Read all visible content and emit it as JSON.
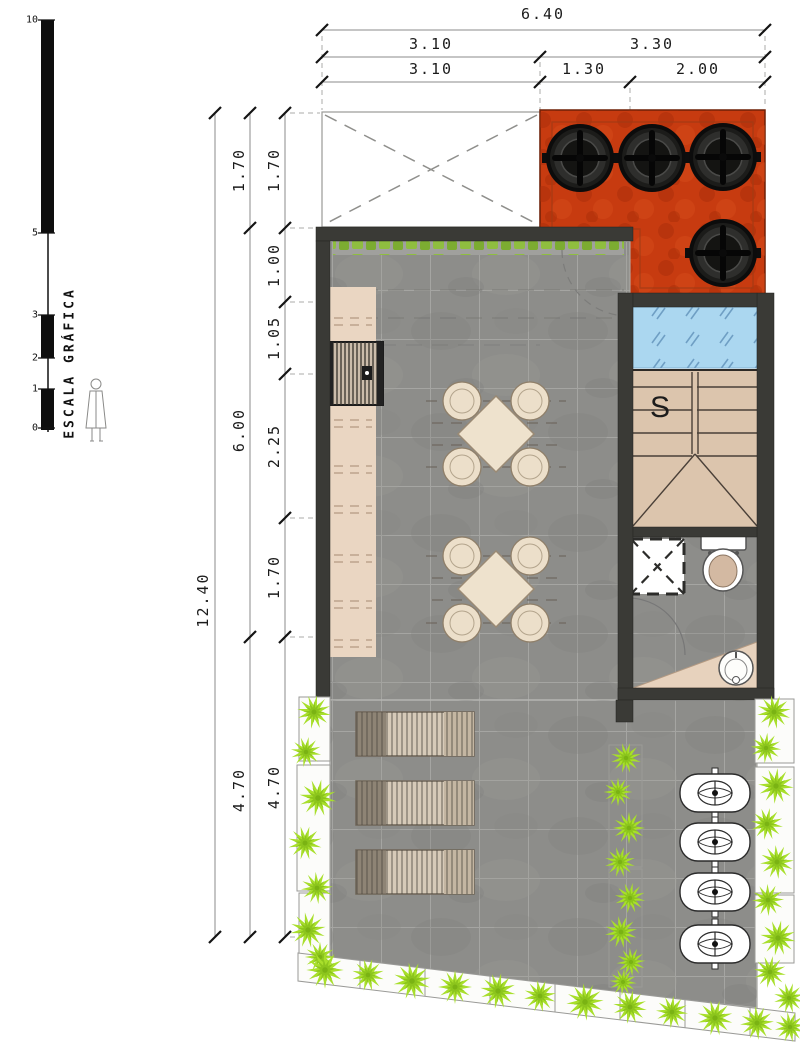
{
  "scale_bar": {
    "label": "ESCALA GRÁFICA",
    "ticks": [
      "10",
      "5",
      "3",
      "2",
      "1",
      "0"
    ]
  },
  "dimensions": {
    "top_total": "6.40",
    "top_row2": [
      "3.10",
      "3.30"
    ],
    "top_row3": [
      "3.10",
      "1.30",
      "2.00"
    ],
    "left_total": "12.40",
    "left_middle": [
      "1.70",
      "6.00",
      "4.70"
    ],
    "left_inner": [
      "1.70",
      "1.00",
      "1.05",
      "2.25",
      "1.70",
      "4.70"
    ]
  },
  "plan": {
    "stair_label": "S"
  },
  "colors": {
    "red_zone": "#c73b10",
    "pool_blue": "#abd7f0",
    "plant_green": "#a8df2b",
    "hedge_green": "#8fbe3f",
    "floor_gray": "#8d8d8a",
    "wall_dark": "#3a3a36",
    "stair_tan": "#dcc5ad",
    "counter_tan": "#ead6c2"
  }
}
